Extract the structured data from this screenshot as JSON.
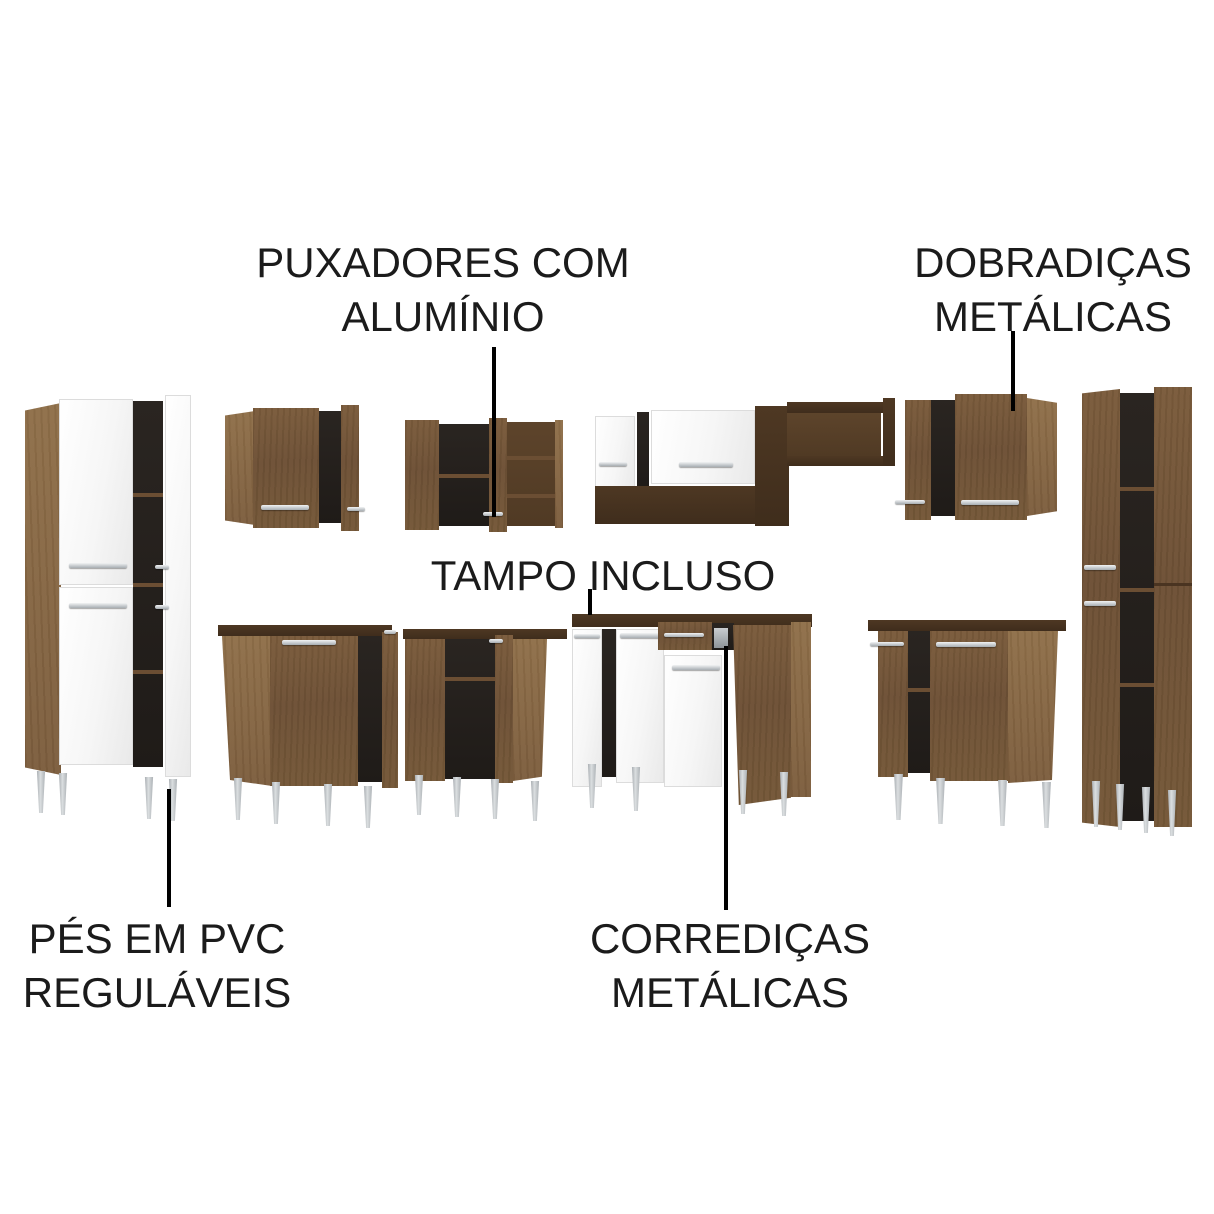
{
  "annotations": {
    "handles": {
      "line1": "PUXADORES COM",
      "line2": "ALUMÍNIO"
    },
    "hinges": {
      "line1": "DOBRADIÇAS",
      "line2": "METÁLICAS"
    },
    "countertop": {
      "line1": "TAMPO INCLUSO"
    },
    "feet": {
      "line1": "PÉS EM PVC",
      "line2": "REGULÁVEIS"
    },
    "slides": {
      "line1": "CORREDIÇAS",
      "line2": "METÁLICAS"
    }
  },
  "colors": {
    "background": "#ffffff",
    "text": "#1b1b1b",
    "callout_line": "#000000",
    "wood_medium": "#6e5136",
    "wood_light": "#8a6a46",
    "wood_espresso": "#46331f",
    "cabinet_interior": "#26211d",
    "door_white": "#f5f5f5",
    "metal_silver": "#b9bec3"
  },
  "furniture_pieces": [
    "tall-cabinet-left",
    "wall-corner-cabinet-a",
    "wall-cabinet-b",
    "wall-shelf-unit-c",
    "wall-corner-cabinet-d",
    "tall-cabinet-right",
    "base-cabinet-e",
    "base-cabinet-f",
    "counter-cabinet-with-drawer",
    "base-cabinet-h"
  ]
}
